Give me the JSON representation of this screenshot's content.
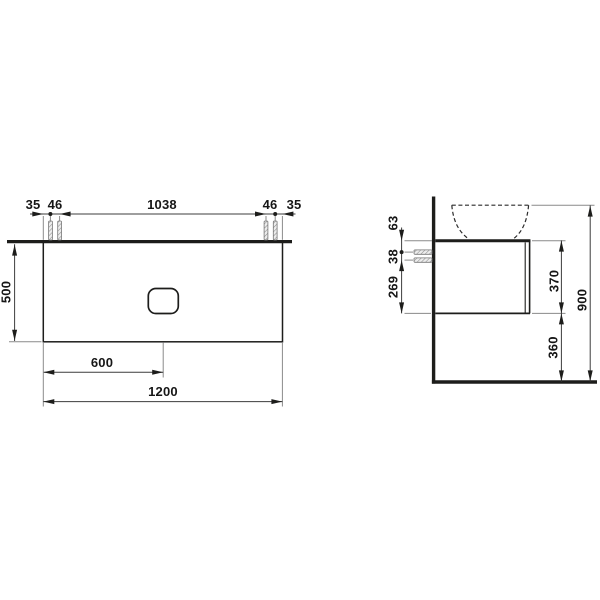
{
  "front_view": {
    "top_chain": [
      "35",
      "46",
      "1038",
      "46",
      "35"
    ],
    "height": "500",
    "cutout_offset": "600",
    "width": "1200"
  },
  "side_view": {
    "top_to_bolt": "63",
    "bolt_spacing": "38",
    "bolt_to_bottom": "269",
    "body_height": "370",
    "bottom_clearance": "360",
    "total_height": "900"
  },
  "colors": {
    "line": "#1d1d1b",
    "extension_line": "#8a8a8a",
    "bolt_fill": "#ededed"
  }
}
